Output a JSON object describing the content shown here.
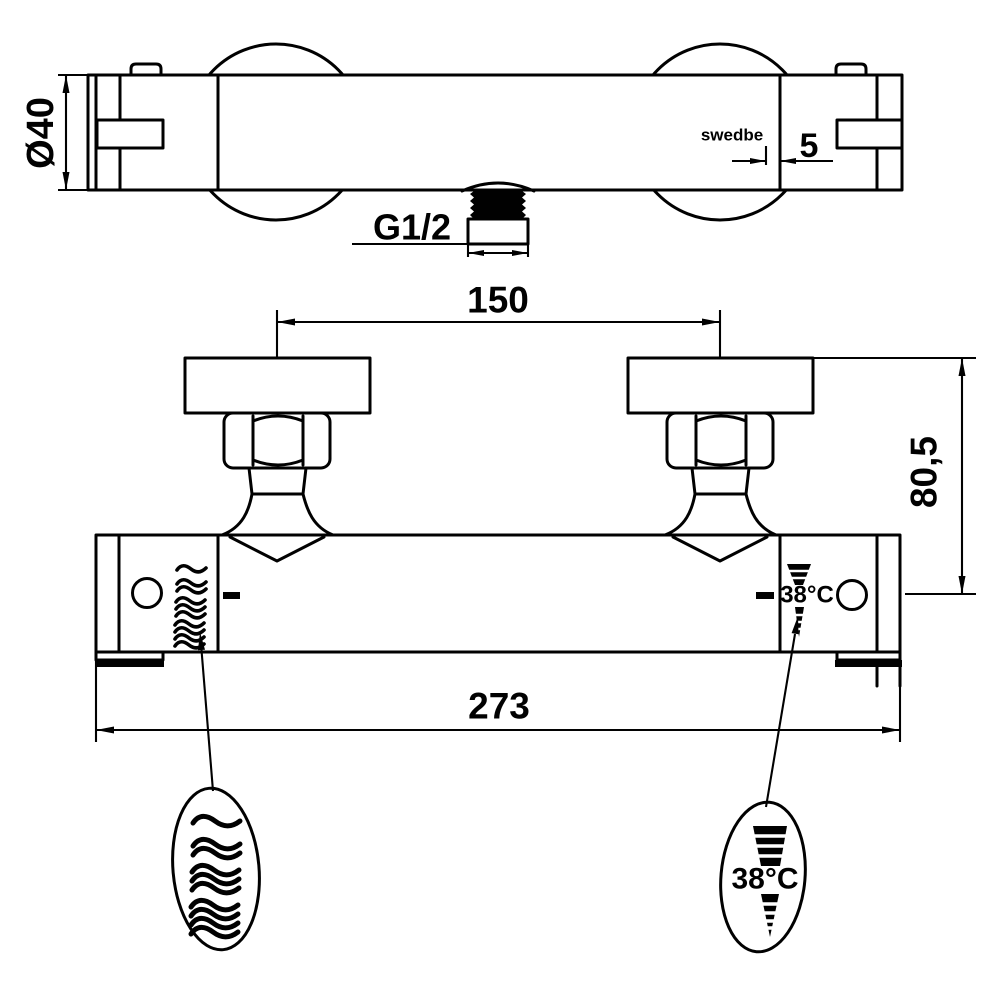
{
  "drawing": {
    "type": "technical-dimension-drawing",
    "product": "thermostatic-shower-mixer",
    "background_color": "#ffffff",
    "line_color": "#010101",
    "brand_label": "swedbe",
    "top_view": {
      "diameter_label": "Ø40",
      "logo_offset_label": "5",
      "outlet_thread_label": "G1/2"
    },
    "front_view": {
      "connection_spacing_label": "150",
      "center_height_label": "80,5",
      "overall_length_label": "273",
      "temperature_knob_label": "38°C"
    },
    "callouts": {
      "flow_balloon_symbol": "increasing-water-flow-waves",
      "temperature_balloon_label": "38°C"
    }
  }
}
